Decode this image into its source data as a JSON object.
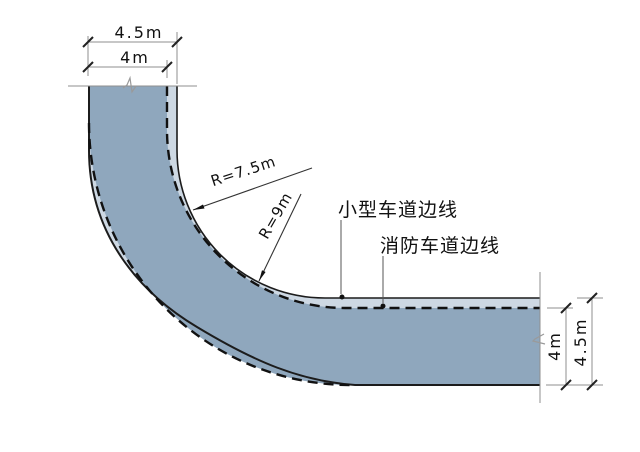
{
  "diagram": {
    "dimensions": {
      "top_outer": "4.5m",
      "top_inner": "4m",
      "right_inner": "4m",
      "right_outer": "4.5m"
    },
    "radii": {
      "small_vehicle": "R=7.5m",
      "fire_lane": "R=9m"
    },
    "labels": {
      "small_vehicle_lane_edge": "小型车道边线",
      "fire_lane_edge": "消防车道边线"
    },
    "colors": {
      "road_fill": "#8fa7bd",
      "lane_strip_fill": "#cdd8e3",
      "edge_line": "#1c1c1c",
      "dashed_line": "#111111",
      "dim_line": "#8f8f8f",
      "leader_line": "#555555",
      "text": "#111111"
    }
  }
}
